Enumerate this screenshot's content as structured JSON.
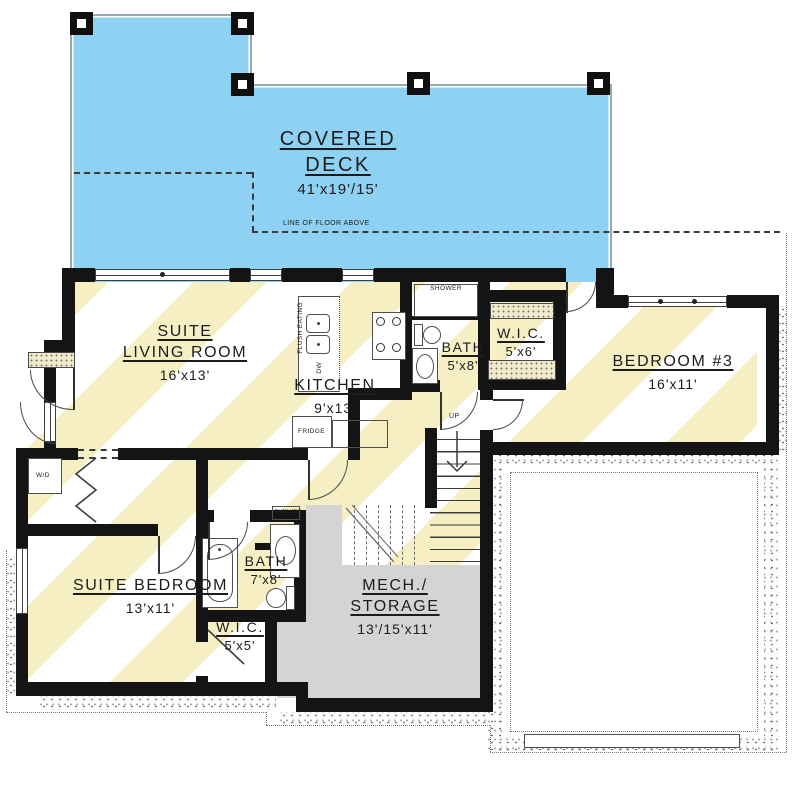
{
  "plan": {
    "title_note": "LINE OF FLOOR ABOVE",
    "deck": {
      "lines": [
        "COVERED",
        "DECK"
      ],
      "dims": "41'x19'/15'"
    },
    "rooms": {
      "living": {
        "lines": [
          "SUITE",
          "LIVING ROOM"
        ],
        "dims": "16'x13'"
      },
      "kitchen": {
        "lines": [
          "KITCHEN"
        ],
        "dims": "9'x13'"
      },
      "bath_upper": {
        "lines": [
          "BATH"
        ],
        "dims": "5'x8'"
      },
      "wic_upper": {
        "lines": [
          "W.I.C."
        ],
        "dims": "5'x6'"
      },
      "bedroom3": {
        "lines": [
          "BEDROOM #3"
        ],
        "dims": "16'x11'"
      },
      "suite_bedroom": {
        "lines": [
          "SUITE BEDROOM"
        ],
        "dims": "13'x11'"
      },
      "bath_lower": {
        "lines": [
          "BATH"
        ],
        "dims": "7'x8'"
      },
      "wic_lower": {
        "lines": [
          "W.I.C."
        ],
        "dims": "5'x5'"
      },
      "mech": {
        "lines": [
          "MECH./",
          "STORAGE"
        ],
        "dims": "13'/15'x11'"
      }
    },
    "fixtures": {
      "shower": "SHOWER",
      "shelves": "SHELVES",
      "washer_dryer": "W/D",
      "fridge": "FRIDGE",
      "dishwasher": "DW",
      "flush_eating": "FLUSH EATING",
      "stairs_up": "UP"
    },
    "colors": {
      "deck_blue": "#8ed1f2",
      "floor_stripe_yellow": "#f5efc3",
      "mech_gray": "#d4d4d4",
      "wall_black": "#141414",
      "stipple_dot": "#6f6f6f"
    }
  }
}
